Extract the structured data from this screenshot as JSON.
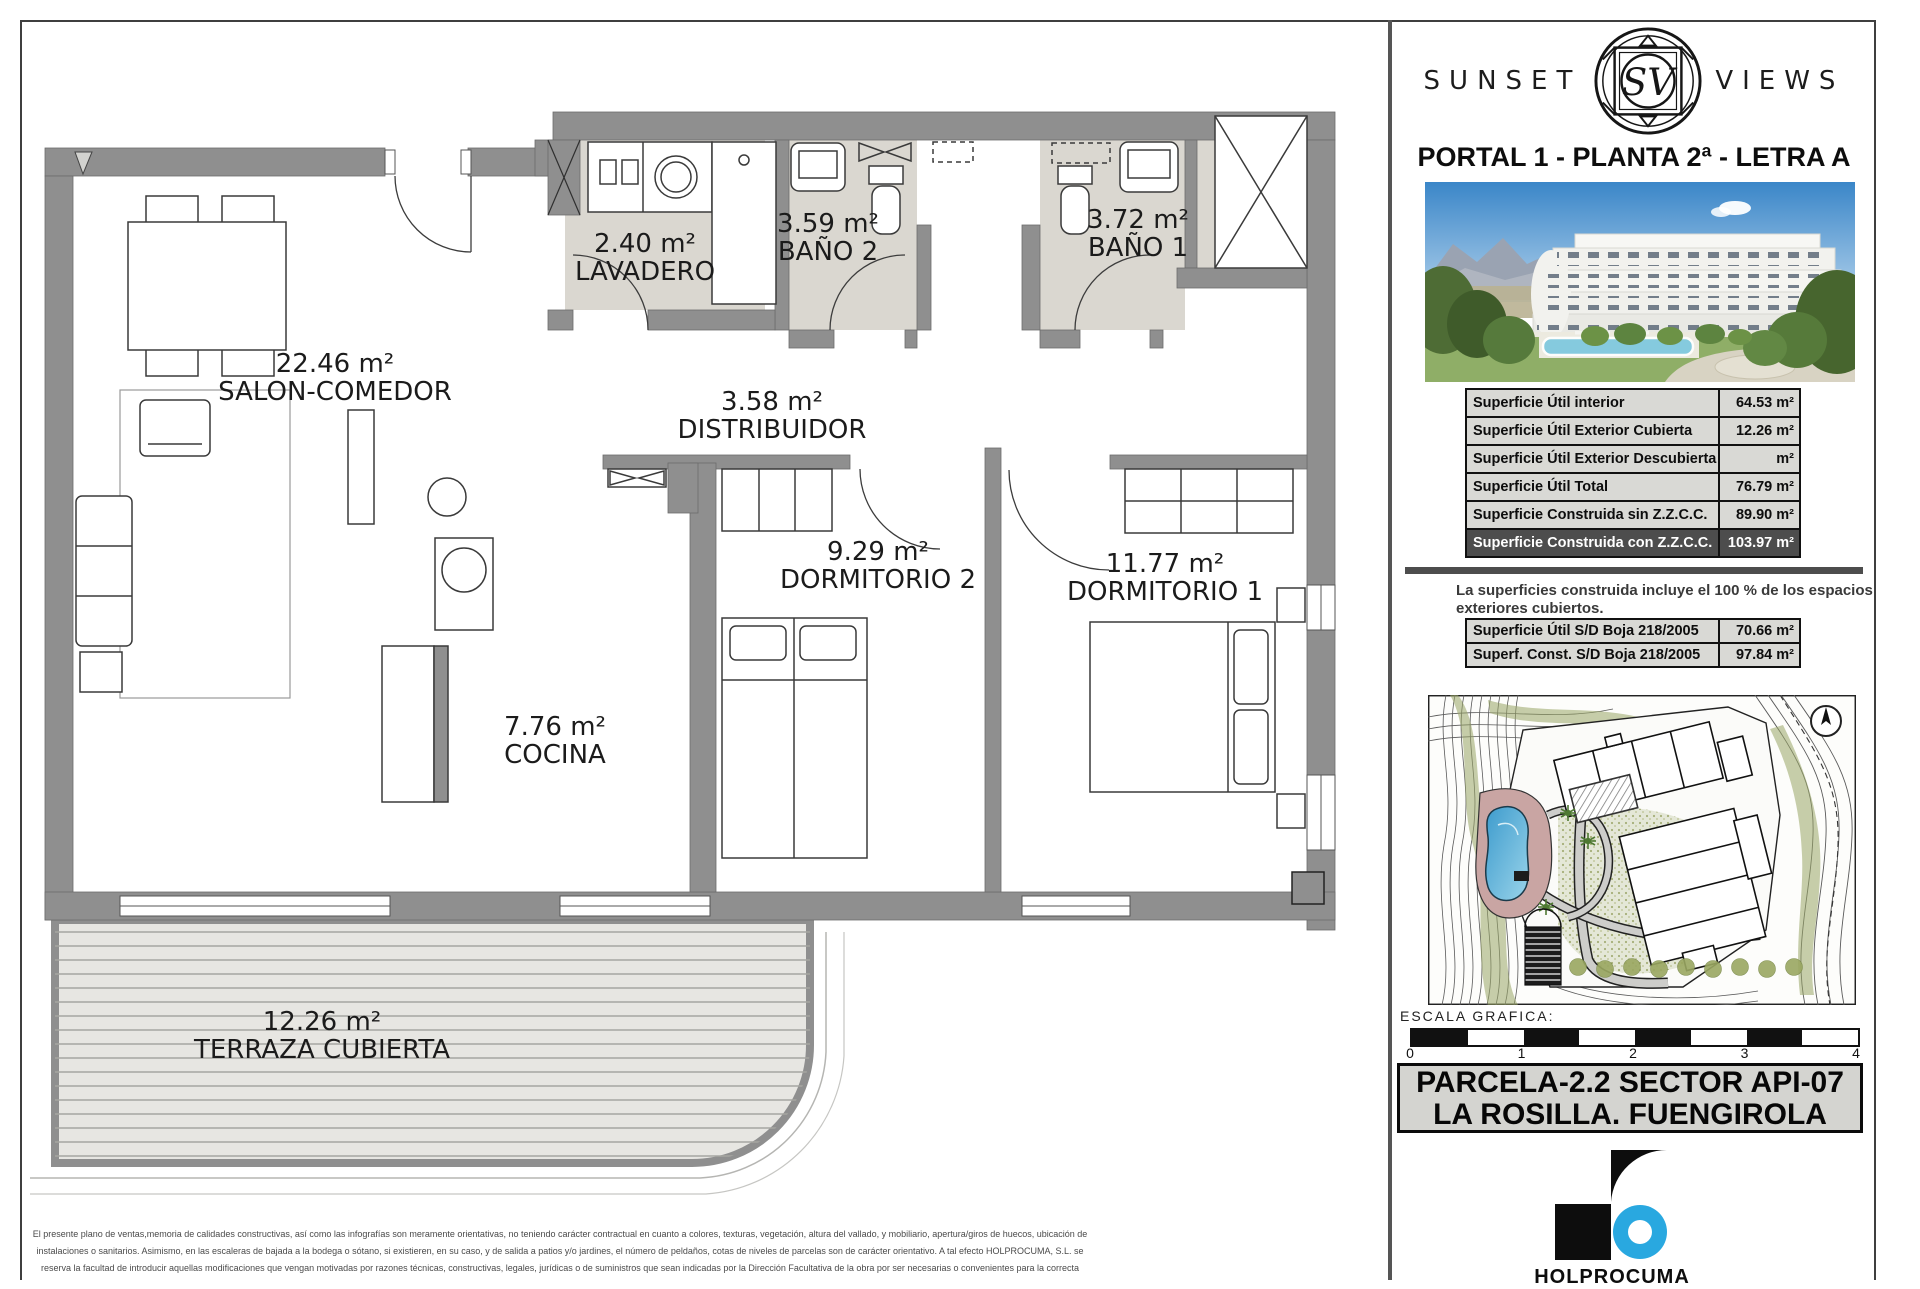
{
  "floorplan": {
    "rooms": [
      {
        "area": "22.46 m²",
        "name": "SALON-COMEDOR"
      },
      {
        "area": "2.40 m²",
        "name": "LAVADERO"
      },
      {
        "area": "3.59 m²",
        "name": "BAÑO 2"
      },
      {
        "area": "3.72 m²",
        "name": "BAÑO 1"
      },
      {
        "area": "3.58 m²",
        "name": "DISTRIBUIDOR"
      },
      {
        "area": "9.29 m²",
        "name": "DORMITORIO 2"
      },
      {
        "area": "11.77 m²",
        "name": "DORMITORIO 1"
      },
      {
        "area": "7.76 m²",
        "name": "COCINA"
      },
      {
        "area": "12.26 m²",
        "name": "TERRAZA CUBIERTA"
      }
    ],
    "disclaimer": [
      "El presente plano de ventas,memoria de calidades constructivas, así como las infografías son meramente orientativas, no teniendo carácter contractual en cuanto a colores, texturas, vegetación, altura del vallado, y mobiliario, apertura/giros de huecos, ubicación de",
      "instalaciones o sanitarios. Asimismo, en las escaleras de bajada a la bodega o sótano, si existieren, en su caso, y de salida a patios y/o jardines, el número de peldaños, cotas de niveles de parcelas son de carácter orientativo. A tal efecto HOLPROCUMA, S.L.  se",
      "reserva la facultad de introducir aquellas modificaciones que vengan motivadas por razones técnicas, constructivas, legales, jurídicas o de suministros que sean indicadas por la Dirección Facultativa de la obra por ser necesarias o convenientes para la correcta"
    ]
  },
  "panel": {
    "brand_left": "SUNSET",
    "brand_right": "VIEWS",
    "monogram": "SV",
    "title": "PORTAL 1 - PLANTA 2ª - LETRA A",
    "surface_table": {
      "rows": [
        {
          "label": "Superficie Útil interior",
          "value": "64.53",
          "unit": "m²"
        },
        {
          "label": "Superficie Útil Exterior Cubierta",
          "value": "12.26",
          "unit": "m²"
        },
        {
          "label": "Superficie Útil Exterior Descubierta",
          "value": "",
          "unit": "m²"
        },
        {
          "label": "Superficie Útil Total",
          "value": "76.79",
          "unit": "m²"
        },
        {
          "label": "Superficie Construida sin Z.Z.C.C.",
          "value": "89.90",
          "unit": "m²"
        },
        {
          "label": "Superficie Construida con Z.Z.C.C.",
          "value": "103.97",
          "unit": "m²"
        }
      ]
    },
    "note_line1": "La superficies construida incluye el 100 % de los espacios",
    "note_line2": "exteriores cubiertos.",
    "boja_table": {
      "rows": [
        {
          "label": "Superficie Útil S/D Boja 218/2005",
          "value": "70.66",
          "unit": "m²"
        },
        {
          "label": "Superf. Const. S/D Boja 218/2005",
          "value": "97.84",
          "unit": "m²"
        }
      ]
    },
    "escala_label": "ESCALA  GRAFICA:",
    "scale_ticks": [
      "0",
      "1",
      "2",
      "3",
      "4"
    ],
    "parcel_line1": "PARCELA-2.2 SECTOR API-07",
    "parcel_line2": "LA ROSILLA. FUENGIROLA",
    "developer": "HOLPROCUMA",
    "accent_blue": "#29a8e0"
  }
}
